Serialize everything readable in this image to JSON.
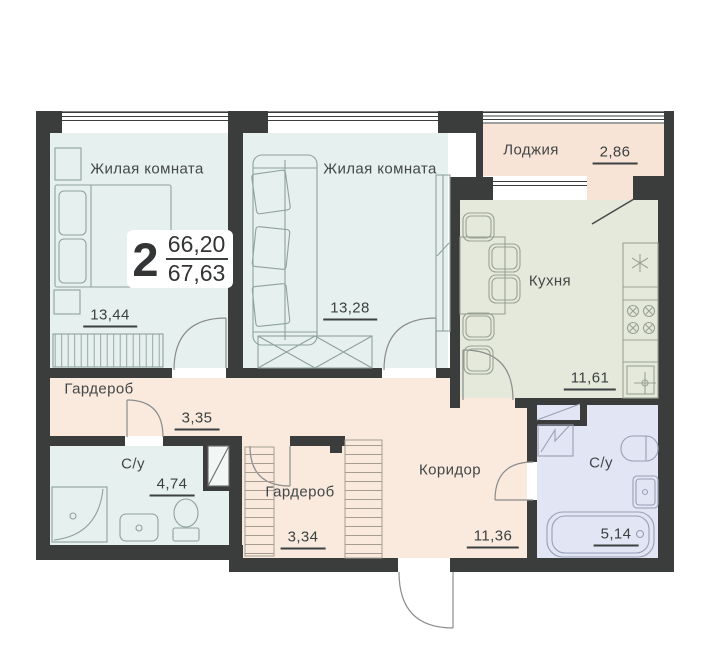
{
  "plan_card": {
    "rooms_count": "2",
    "area_living": "66,20",
    "area_total": "67,63"
  },
  "rooms": [
    {
      "id": "living-1",
      "name": "Жилая комната",
      "area": "13,44"
    },
    {
      "id": "living-2",
      "name": "Жилая комната",
      "area": "13,28"
    },
    {
      "id": "loggia",
      "name": "Лоджия",
      "area": "2,86"
    },
    {
      "id": "kitchen",
      "name": "Кухня",
      "area": "11,61"
    },
    {
      "id": "wardrobe-1",
      "name": "Гардероб",
      "area": "3,35"
    },
    {
      "id": "bathroom-1",
      "name": "С/у",
      "area": "4,74"
    },
    {
      "id": "wardrobe-2",
      "name": "Гардероб",
      "area": "3,34"
    },
    {
      "id": "corridor",
      "name": "Коридор",
      "area": "11,36"
    },
    {
      "id": "bathroom-2",
      "name": "С/у",
      "area": "5,14"
    }
  ],
  "colors": {
    "wall": "#3B3C3C",
    "living_fill": "#E6F0EE",
    "kitchen_fill": "#E5E9DB",
    "hall_fill": "#F9EADD",
    "loggia_fill": "#F8E4D7",
    "bathroom2_fill": "#E1E5F4",
    "furniture_line": "#8FA29C",
    "text": "#3C4041"
  }
}
